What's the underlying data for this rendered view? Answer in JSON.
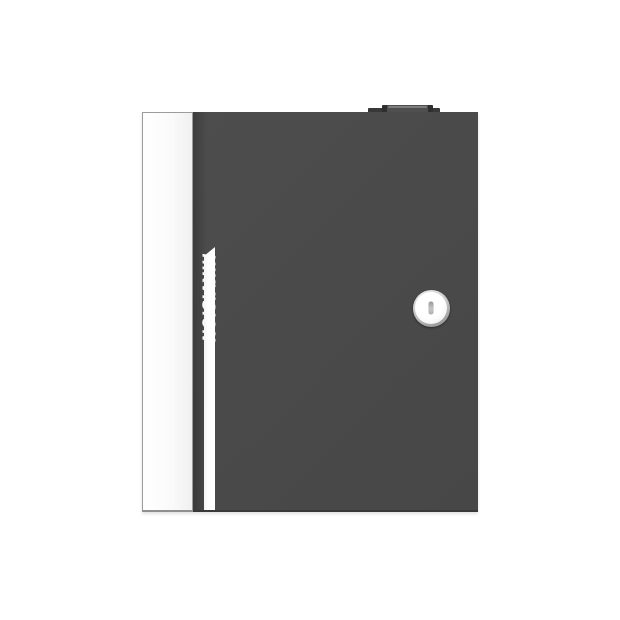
{
  "photo": {
    "subject": "wall-mount access controller metal enclosure, front view",
    "brand": "HIKVISION",
    "parts": {
      "side_panel": "white left side panel",
      "front_door": "dark grey hinged front door",
      "accent_stripe": "white vertical stripe with beveled top",
      "key_lock": "round cam lock with vertical keyhole slot",
      "top_tab": "small raised tab on top edge"
    },
    "colors": {
      "background": "#ffffff",
      "door": "#4a4a4a",
      "door_edge_shadow": "#3b3b3b",
      "side_panel": "#fafafa",
      "panel_border": "#9c9c9c",
      "stripe": "#fcfcfc",
      "logo_text": "#fafafa",
      "lock_ring": "#8d8d8d",
      "lock_face": "#ffffff",
      "keyhole": "#b2b2b2",
      "top_tab": "#383838"
    }
  }
}
